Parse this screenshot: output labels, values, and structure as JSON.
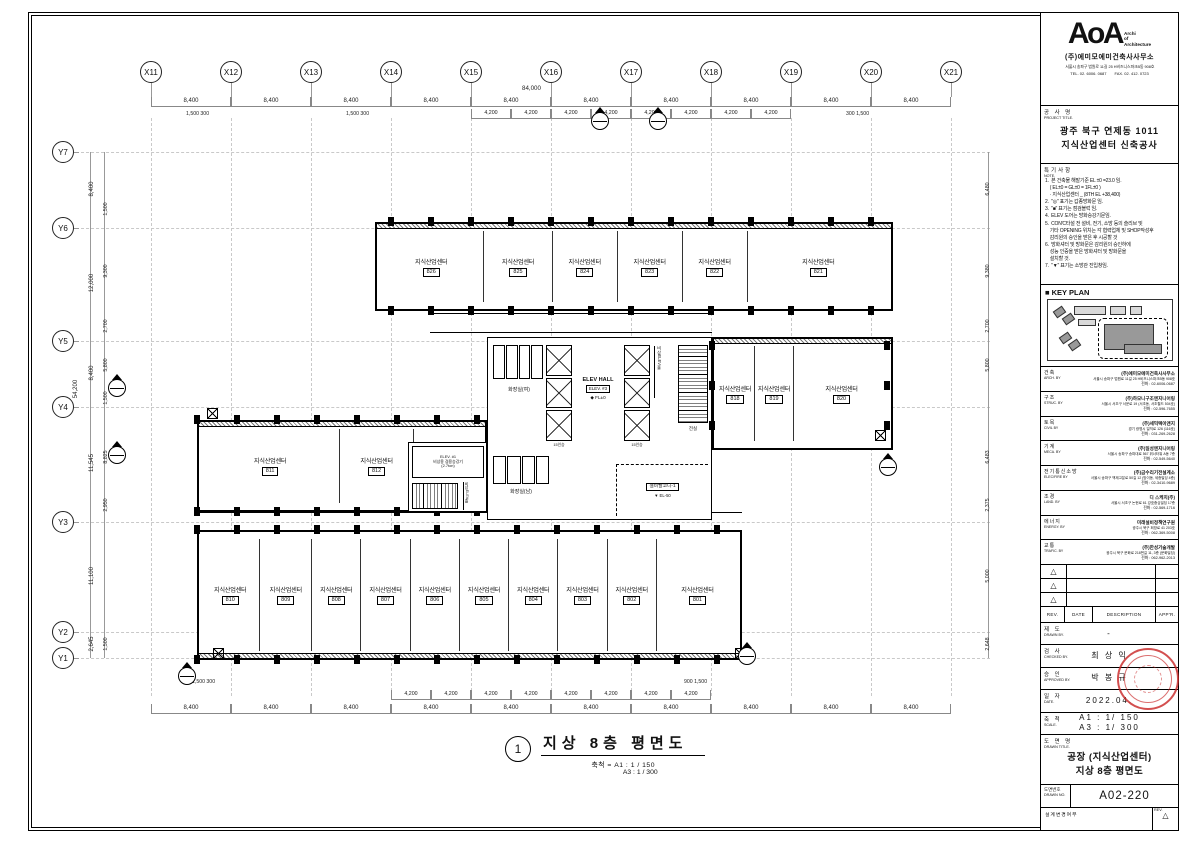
{
  "tb": {
    "logo": {
      "main": "AoA",
      "tag1": "Archi",
      "tag2": "of",
      "tag3": "Architecture"
    },
    "firm": {
      "name": "(주)에미모에미건축사사무소",
      "address": "서울시 송파구 법원로 11길 25 H비즈니스파크B동 908호",
      "tel": "TEL. 02. 6006. 0687",
      "fax": "FAX. 02. 412. 0723"
    },
    "project": {
      "label_ko": "공 사 명",
      "label_en": "PROJECT TITLE.",
      "line1": "광주 북구 연제동 1011",
      "line2": "지식산업센터 신축공사"
    },
    "notes": {
      "label_ko": "특기사항",
      "label_en": "NOTE.",
      "items": [
        "1.  본 건축물 해발기준 EL ±0 =23.0 임.",
        "    ( EL±0 = GL±0 = 1FL±0 )",
        "    · 지식산업센터 _ (8TH EL +38,400)",
        "2.  \"◎\" 표기는 갑종방화문 임.",
        "3.  \"■\" 표기는 점검블럭 임.",
        "4.  ELEV 도어는 방화승강기문임.",
        "5.  CON'C타설 전 설비, 전기, 소방 등의 슬리브 및",
        "    기타 OPENING 위치는 각 협력업체 및 SHOP작성후",
        "    감리원의 승인을 받은 후 시공할 것",
        "6.  방화셔터 및 방화문은 감리원의 승인하에",
        "    성능 인증을 받은 방화셔터 및 방화문을",
        "    설치할 것.",
        "7.  \"▼\" 표기는 소방관 진입창임."
      ]
    },
    "key_plan": {
      "label": "■ KEY PLAN"
    },
    "consultants": [
      {
        "role_ko": "건축",
        "role_en": "ARCH. BY",
        "company": "(주)에미모에미건축사사무소",
        "address": "서울시 송파구 법원로 11길 25 H비즈니스파크B동 908호",
        "tel": "전화 : 02-6006-0687"
      },
      {
        "role_ko": "구조",
        "role_en": "STRUC. BY",
        "company": "(주)하모니구조엔지니어링",
        "address": "서울시 서초구 서운로 19 (서초동, 서초월드 504호)",
        "tel": "전화 : 02-596-7655"
      },
      {
        "role_ko": "토목",
        "role_en": "CIVIL BY",
        "company": "(주)세믹텍이앤지",
        "address": "경기 광명시 일직로 126 (116호)",
        "tel": "전화 : 031-269-2628"
      },
      {
        "role_ko": "기계",
        "role_en": "MECA. BY",
        "company": "(주)일성엔지니어링",
        "address": "서울시 송파구 송파대로 567 위너타워 A동 7층",
        "tel": "전화 : 02-549-5640"
      },
      {
        "role_ko": "전기통신소방",
        "role_en": "ELEC/FIRE BY",
        "company": "(주)금수리기전설계소",
        "address": "서울시 송파구 백제고분로 50길 12 (방이동, 세종빌딩 4층)",
        "tel": "전화 : 02-3410-9689"
      },
      {
        "role_ko": "조경",
        "role_en": "LAND. BY",
        "company": "디 스케치(주)",
        "address": "서울시 서초구 논현로 61 강호중심빌딩 17층",
        "tel": "전화 : 02-569-1716"
      },
      {
        "role_ko": "에너지",
        "role_en": "ENERGY. BY",
        "company": "미래설비정책연구원",
        "address": "광주시 북구 희망로 41 203호",
        "tel": "전화 : 062-369-5008"
      },
      {
        "role_ko": "교통",
        "role_en": "TRAFIC. BY",
        "company": "(주)한성기술개발",
        "address": "광주시 북구 문화로 218번길 11, 3층 (문화빌딩)",
        "tel": "전화 : 062-962-2013"
      }
    ],
    "revision_headers": [
      "REV.",
      "DATE",
      "DESCRIPTION",
      "APP'R."
    ],
    "signoff": [
      {
        "ko": "제 도",
        "en": "DRAWN BY.",
        "value": "-"
      },
      {
        "ko": "검 사",
        "en": "CHECKED BY.",
        "value": "최 상 익"
      },
      {
        "ko": "승 인",
        "en": "APPROVED BY.",
        "value": "박 봉 규"
      },
      {
        "ko": "일 자",
        "en": "DATE.",
        "value": "2022.04."
      },
      {
        "ko": "축 척",
        "en": "SCALE.",
        "value": "A1 : 1/ 150\nA3 : 1/ 300"
      }
    ],
    "drawing_title": {
      "label_ko": "도 면 명",
      "label_en": "DRAWN TITLE.",
      "line1": "공장 (지식산업센터)",
      "line2": "지상 8층 평면도"
    },
    "drawing_no": {
      "label_ko": "도면번호",
      "label_en": "DRAWN NO.",
      "value": "A02-220"
    },
    "footer": {
      "label": "설계변경여부",
      "rev": "REV.",
      "triangle": "△"
    },
    "triangle": "△"
  },
  "plan": {
    "caption": {
      "number": "1",
      "title": "지상 8층 평면도",
      "scale1": "축척 = A1 : 1 / 150",
      "scale2": "A3 : 1 / 300"
    },
    "grid_x": [
      "X11",
      "X12",
      "X13",
      "X14",
      "X15",
      "X16",
      "X17",
      "X18",
      "X19",
      "X20",
      "X21"
    ],
    "grid_y": [
      "Y7",
      "Y6",
      "Y5",
      "Y4",
      "Y3",
      "Y2",
      "Y1"
    ],
    "dims": {
      "total_top": "84,000",
      "top": [
        "8,400",
        "8,400",
        "8,400",
        "8,400",
        "8,400",
        "8,400",
        "8,400",
        "8,400",
        "8,400",
        "8,400"
      ],
      "top_sub": [
        "4,200",
        "4,200",
        "4,200",
        "4,200",
        "4,200",
        "4,200",
        "4,200",
        "4,200"
      ],
      "bottom": [
        "8,400",
        "8,400",
        "8,400",
        "8,400",
        "8,400",
        "8,400",
        "8,400",
        "8,400",
        "8,400",
        "8,400"
      ],
      "bottom_sub": [
        "4,200",
        "4,200",
        "4,200",
        "4,200",
        "4,200",
        "4,200",
        "4,200",
        "4,200"
      ],
      "left_total": "54,200",
      "left_main": [
        "8,400",
        "12,000",
        "8,400",
        "11,545",
        "11,100",
        "2,645"
      ],
      "left_sub": [
        "1,500",
        "9,300",
        "2,700",
        "5,800",
        "1,500",
        "8,825",
        "2,950",
        "1,500"
      ],
      "right": [
        "6,480",
        "9,380",
        "2,700",
        "5,800",
        "6,483",
        "2,375",
        "5,000",
        "2,648"
      ],
      "pair_a": "1,500  300",
      "pair_b": "300  1,500",
      "pair_c": "900  1,500"
    },
    "rooms_top": [
      {
        "name": "지식산업센터",
        "no": "826",
        "w": 1.55
      },
      {
        "name": "지식산업센터",
        "no": "825",
        "w": 1
      },
      {
        "name": "지식산업센터",
        "no": "824",
        "w": 0.95
      },
      {
        "name": "지식산업센터",
        "no": "823",
        "w": 0.95
      },
      {
        "name": "지식산업센터",
        "no": "822",
        "w": 0.95
      },
      {
        "name": "지식산업센터",
        "no": "821",
        "w": 2.1
      }
    ],
    "rooms_mid": [
      {
        "name": "지식산업센터",
        "no": "811",
        "w": 1.9
      },
      {
        "name": "지식산업센터",
        "no": "812",
        "w": 1
      },
      {
        "name": "지식산업센터",
        "no": "813",
        "w": 0.95
      }
    ],
    "rooms_east": [
      {
        "name": "지식산업센터",
        "no": "818",
        "w": 1
      },
      {
        "name": "지식산업센터",
        "no": "819",
        "w": 1
      },
      {
        "name": "지식산업센터",
        "no": "820",
        "w": 2.5
      }
    ],
    "rooms_south": [
      {
        "name": "지식산업센터",
        "no": "810",
        "w": 1.15
      },
      {
        "name": "지식산업센터",
        "no": "809",
        "w": 1
      },
      {
        "name": "지식산업센터",
        "no": "808",
        "w": 0.95
      },
      {
        "name": "지식산업센터",
        "no": "807",
        "w": 0.95
      },
      {
        "name": "지식산업센터",
        "no": "806",
        "w": 0.95
      },
      {
        "name": "지식산업센터",
        "no": "805",
        "w": 0.95
      },
      {
        "name": "지식산업센터",
        "no": "804",
        "w": 0.95
      },
      {
        "name": "지식산업센터",
        "no": "803",
        "w": 0.95
      },
      {
        "name": "지식산업센터",
        "no": "802",
        "w": 0.95
      },
      {
        "name": "지식산업센터",
        "no": "801",
        "w": 1.6
      }
    ],
    "core": {
      "toilet_w": "화장실(여)",
      "toilet_m": "화장실(남)",
      "elev_hall": "ELEV HALL",
      "elev3": "ELEV. #3",
      "fl0": "◆ FL±0",
      "cap15": "15인승",
      "emer_hall": "비상ELEV홀",
      "vest": "전실",
      "equip_balcony": "설비발코니-1",
      "el50": "▼ EL-50",
      "elev1": "ELEV. #1",
      "elev1_desc": "비상용 겸용승강기",
      "elev1_cap": "(2.7ton)",
      "emer_hall2": "비상ELEV홀"
    }
  }
}
